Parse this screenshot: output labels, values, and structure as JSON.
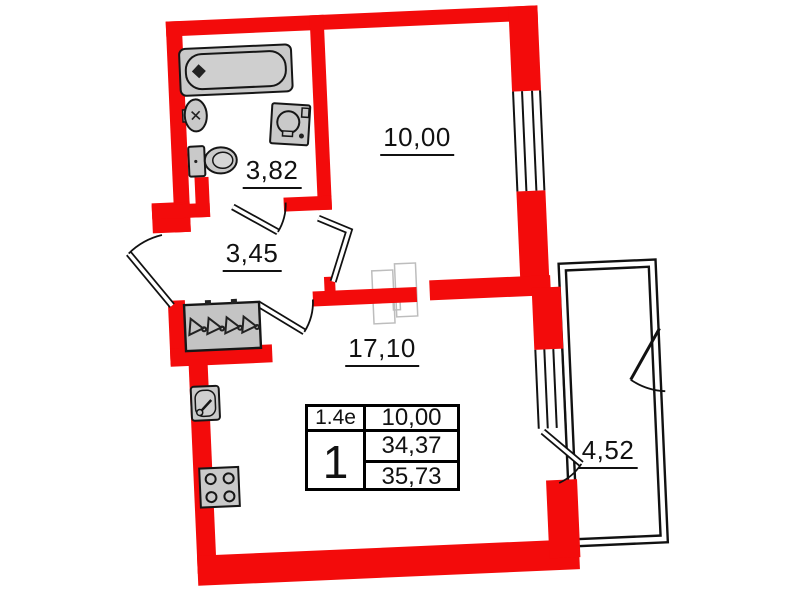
{
  "plan": {
    "title": "1-room apartment floor plan",
    "rooms": [
      {
        "name": "bathroom",
        "area": "3,82"
      },
      {
        "name": "room",
        "area": "10,00"
      },
      {
        "name": "hallway",
        "area": "3,45"
      },
      {
        "name": "living-kitchen",
        "area": "17,10"
      },
      {
        "name": "balcony",
        "area": "4,52"
      }
    ],
    "info_table": {
      "flat_type": "1.4e",
      "room_count": "1",
      "living_area": "10,00",
      "area_without_balcony": "34,37",
      "area_total": "35,73"
    },
    "colors": {
      "wall": "#f30b0b",
      "line": "#111111",
      "furniture": "#c9c9c9",
      "slider_outline": "#bdbdbd"
    }
  }
}
